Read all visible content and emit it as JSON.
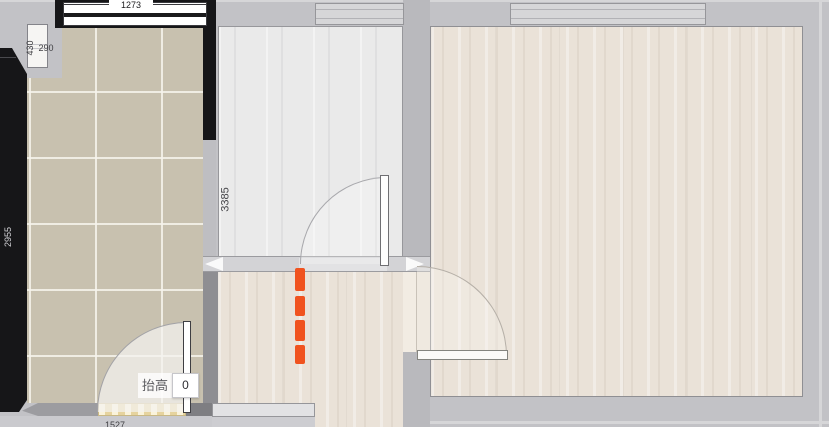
{
  "dimensions": {
    "top_window": "1273",
    "left_vertical": "430",
    "left_horizontal": "290",
    "left_wall": "2955",
    "middle_room": "3385",
    "bottom_wall": "1527"
  },
  "elevation_control": {
    "label": "抬高",
    "value": "0"
  },
  "colors": {
    "accent_dash": "#F0531F",
    "wall_dark": "#161618",
    "wall_gray": "#B9B9BD",
    "tile_floor": "#C8C1AF",
    "wood_floor": "#EAE2D8",
    "gray_floor": "#EAEAEA",
    "threshold": "#F3E4B0"
  },
  "icons": {
    "wall_move_left": "left-arrow",
    "wall_move_right": "right-arrow"
  }
}
